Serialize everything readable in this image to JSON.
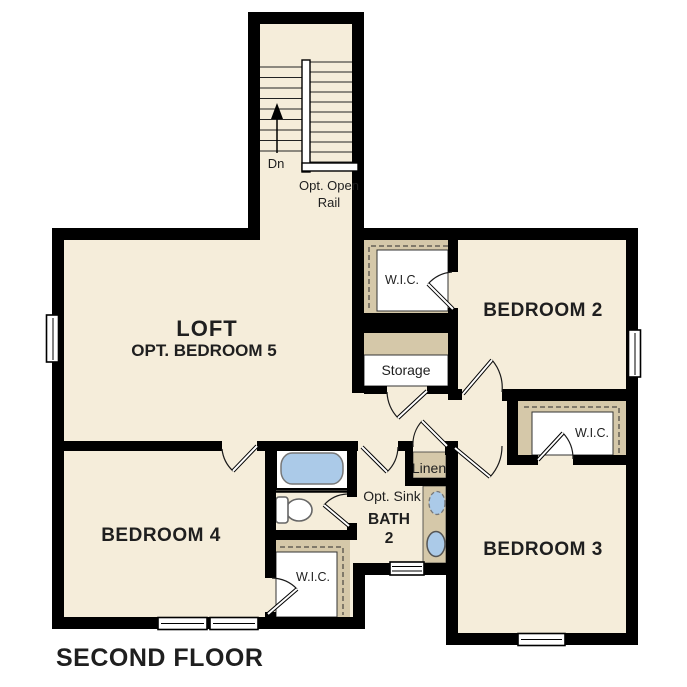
{
  "title": "SECOND FLOOR",
  "colors": {
    "floor": "#f5edda",
    "closet": "#d5c8a9",
    "wall": "#000000",
    "fixture_blue": "#abcae8",
    "text": "#1f1f1f"
  },
  "rooms": {
    "loft": {
      "name": "LOFT",
      "option": "OPT. BEDROOM 5"
    },
    "bedroom2": {
      "name": "BEDROOM 2"
    },
    "bedroom3": {
      "name": "BEDROOM 3"
    },
    "bedroom4": {
      "name": "BEDROOM 4"
    },
    "bath": {
      "name_line1": "BATH",
      "name_line2": "2",
      "opt_sink": "Opt. Sink"
    },
    "storage": {
      "name": "Storage"
    },
    "linen": {
      "name": "Linen"
    },
    "wic_bedroom2": {
      "name": "W.I.C."
    },
    "wic_bedroom3": {
      "name": "W.I.C."
    },
    "wic_bedroom4": {
      "name": "W.I.C."
    }
  },
  "stairs": {
    "down_label": "Dn",
    "rail_label_line1": "Opt. Open",
    "rail_label_line2": "Rail"
  }
}
